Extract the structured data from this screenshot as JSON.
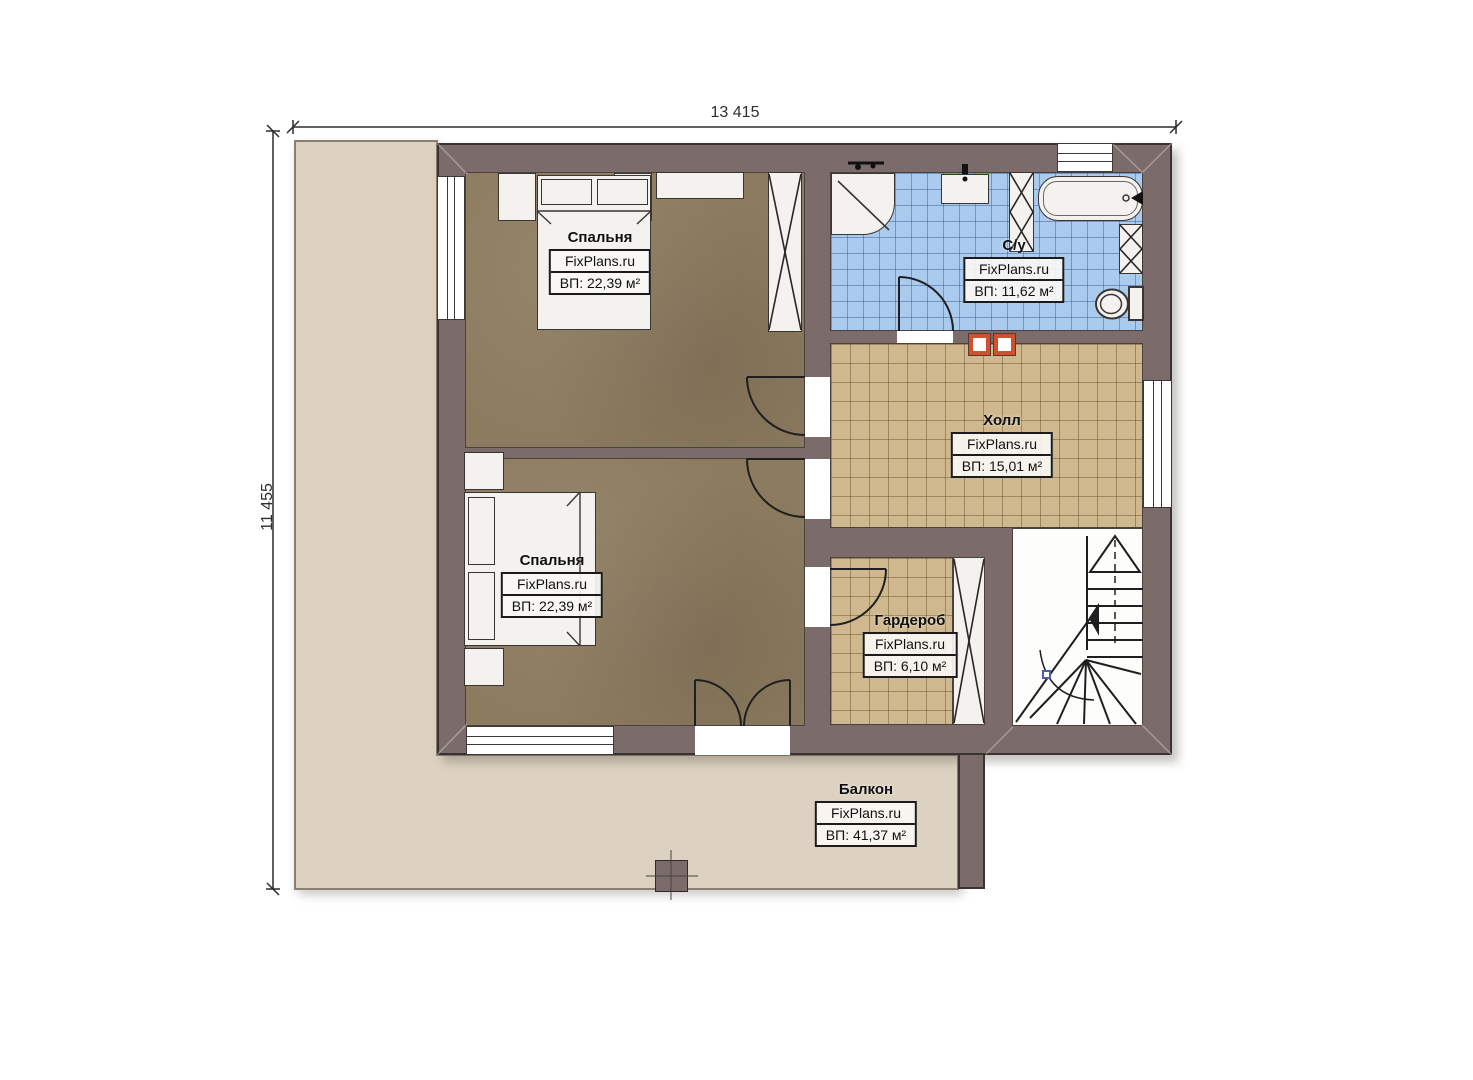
{
  "plan": {
    "type": "floor-plan",
    "watermark": "FixPlans.ru"
  },
  "dimensions": {
    "top": "13 415",
    "left": "11 455"
  },
  "rooms": [
    {
      "id": "bedroom-1",
      "name": "Спальня",
      "brand": "FixPlans.ru",
      "area": "ВП: 22,39 м²"
    },
    {
      "id": "bathroom",
      "name": "С/у",
      "brand": "FixPlans.ru",
      "area": "ВП: 11,62 м²"
    },
    {
      "id": "hall",
      "name": "Холл",
      "brand": "FixPlans.ru",
      "area": "ВП: 15,01 м²"
    },
    {
      "id": "bedroom-2",
      "name": "Спальня",
      "brand": "FixPlans.ru",
      "area": "ВП: 22,39 м²"
    },
    {
      "id": "wardrobe",
      "name": "Гардероб",
      "brand": "FixPlans.ru",
      "area": "ВП: 6,10 м²"
    },
    {
      "id": "balcony",
      "name": "Балкон",
      "brand": "FixPlans.ru",
      "area": "ВП: 41,37 м²"
    }
  ],
  "colors": {
    "wall": "#7b6c6b",
    "wall_outline": "#3a3331",
    "bedroom_floor": "#8c7b5f",
    "bathroom_tile": "#abcbee",
    "hall_tile": "#cfb88d",
    "terrace": "#ddd2c1",
    "fixture_white": "#f3f2ef",
    "shaft_orange": "#cf5130",
    "stair_marker_blue": "#4a5fa5"
  }
}
